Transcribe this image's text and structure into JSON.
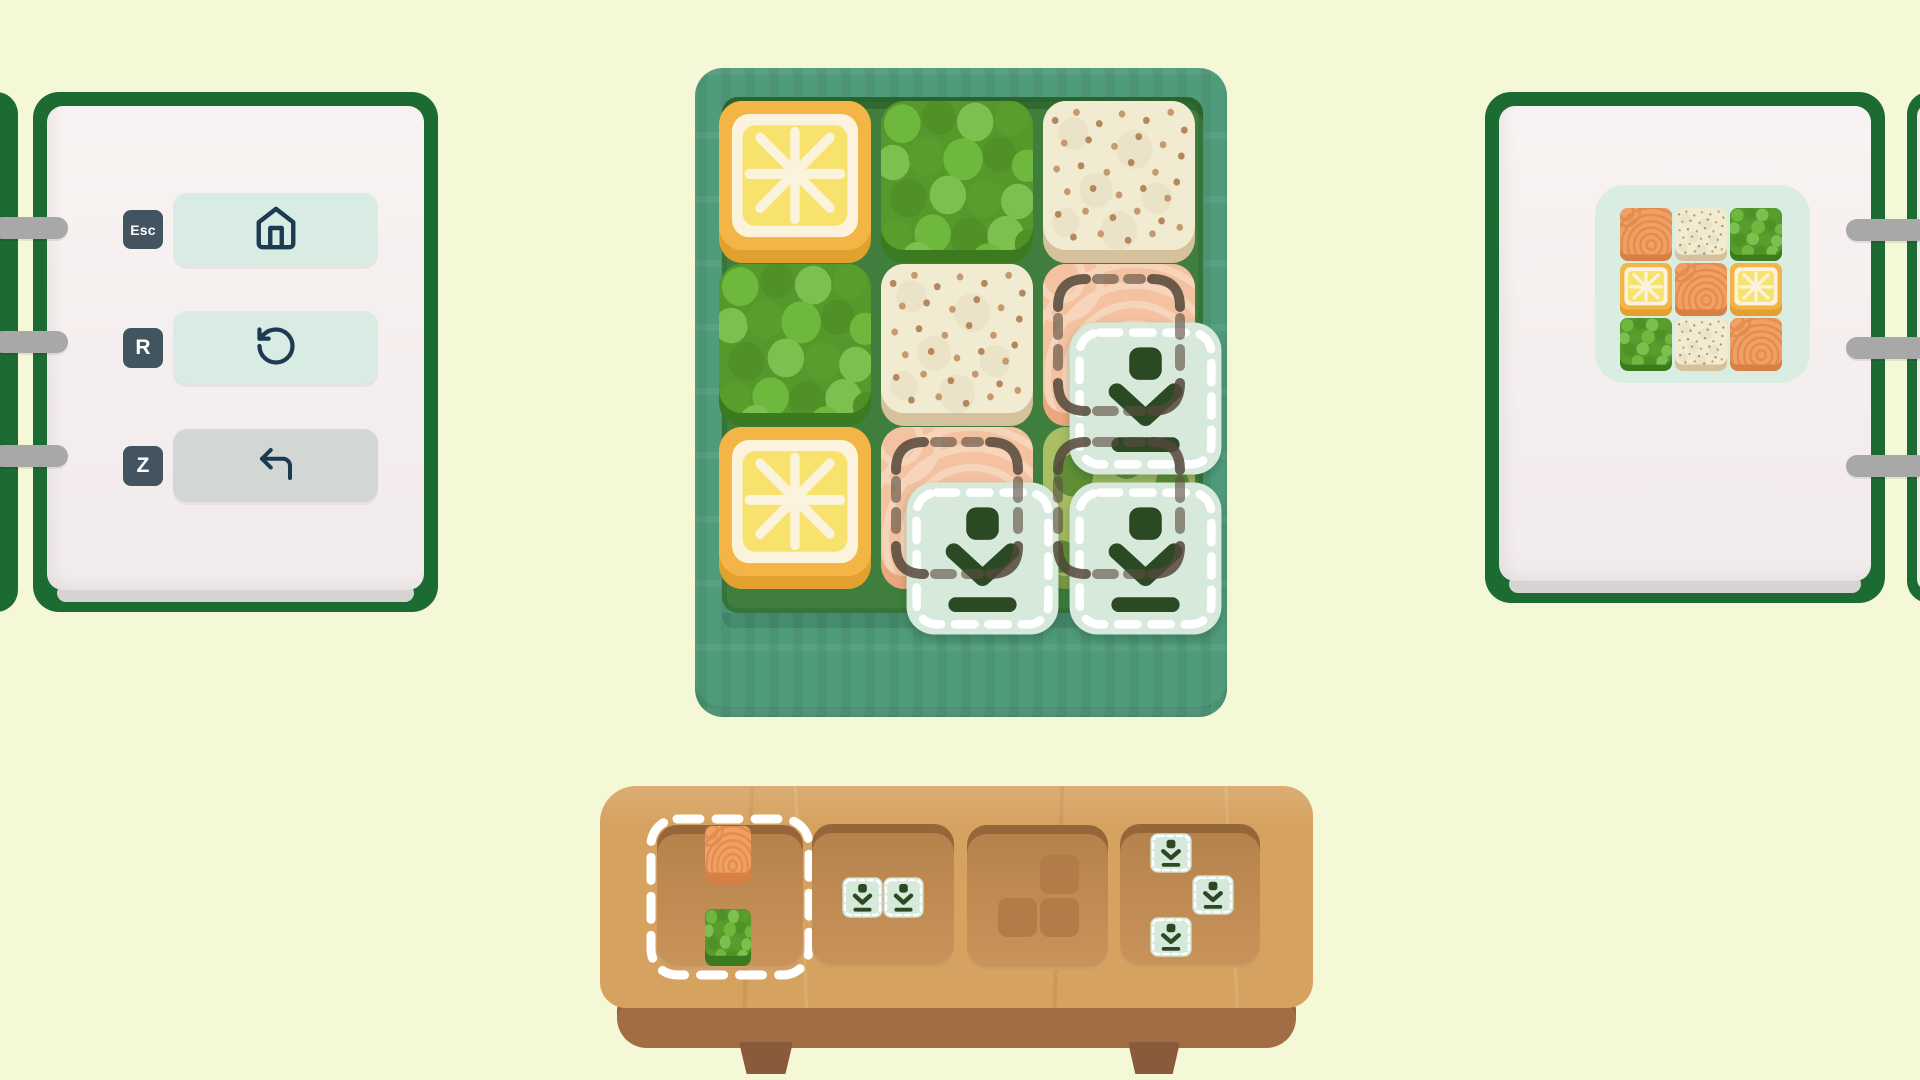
{
  "colors": {
    "page_background": "#f5f8d6",
    "notebook_green": "#1c6b33",
    "notebook_page": "#f5eeee",
    "binder_ring_gray": "#a8a8a8",
    "key_badge": "#42545f",
    "button_mint": "#d9ece3",
    "button_disabled_gray": "#d3d7d4",
    "icon_navy": "#1c3b51",
    "bento_box_teal": "#4f9c7b",
    "bento_inner_green": "#3f7e3c",
    "drop_marker_mint": "#d7e9da",
    "drop_marker_icon_green": "#2b4a23",
    "tray_wood": "#d6a260",
    "tray_recess": "#c08c54",
    "selection_white": "#ffffff",
    "target_mark_brown": "#584c3e"
  },
  "shortcuts_panel": {
    "items": [
      {
        "key": "Esc",
        "icon": "home-icon",
        "action": "home",
        "enabled": true
      },
      {
        "key": "R",
        "icon": "rotate-ccw-icon",
        "action": "restart",
        "enabled": true
      },
      {
        "key": "Z",
        "icon": "undo-icon",
        "action": "undo",
        "enabled": false
      }
    ]
  },
  "board": {
    "rows": 3,
    "cols": 3,
    "grid": [
      [
        "lemon",
        "peas",
        "rice"
      ],
      [
        "peas",
        "rice",
        "salmon"
      ],
      [
        "lemon",
        "salmon",
        "greens"
      ]
    ],
    "marked_cells": [
      {
        "row": 1,
        "col": 2
      },
      {
        "row": 2,
        "col": 1
      },
      {
        "row": 2,
        "col": 2
      }
    ],
    "floating_piece": {
      "tile": "drop-marker",
      "cells": [
        {
          "row": 0,
          "col": 1
        },
        {
          "row": 1,
          "col": 0
        },
        {
          "row": 1,
          "col": 1
        }
      ]
    }
  },
  "tray": {
    "slots": [
      {
        "id": "slot-1",
        "selected": true,
        "piece": {
          "cells": [
            {
              "row": 0,
              "col": 0,
              "food": "salmon-vivid"
            },
            {
              "row": 2,
              "col": 0,
              "food": "peas"
            }
          ]
        }
      },
      {
        "id": "slot-2",
        "selected": false,
        "piece": {
          "cells": [
            {
              "row": 0,
              "col": 0,
              "food": "drop-marker"
            },
            {
              "row": 0,
              "col": 1,
              "food": "drop-marker"
            }
          ]
        }
      },
      {
        "id": "slot-3",
        "selected": false,
        "piece": null,
        "spent_shape": [
          {
            "row": 0,
            "col": 1
          },
          {
            "row": 1,
            "col": 0
          },
          {
            "row": 1,
            "col": 1
          }
        ]
      },
      {
        "id": "slot-4",
        "selected": false,
        "piece": {
          "cells": [
            {
              "row": 0,
              "col": 0,
              "food": "drop-marker"
            },
            {
              "row": 1,
              "col": 1,
              "food": "drop-marker"
            },
            {
              "row": 2,
              "col": 0,
              "food": "drop-marker"
            }
          ]
        }
      }
    ]
  },
  "goal_panel": {
    "grid": [
      [
        "salmon-vivid",
        "rice",
        "peas"
      ],
      [
        "lemon",
        "salmon-vivid",
        "lemon"
      ],
      [
        "peas",
        "rice",
        "salmon-vivid"
      ]
    ]
  }
}
